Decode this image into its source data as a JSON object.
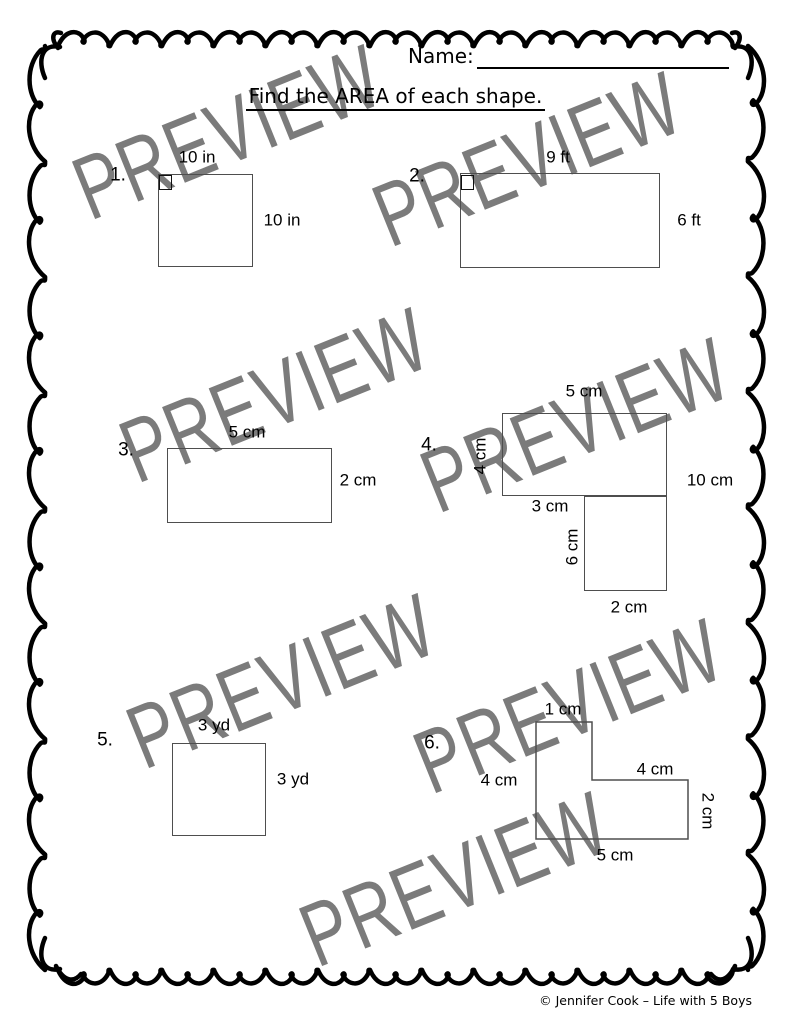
{
  "header": {
    "name_label": "Name:",
    "title": "Find the AREA of each shape."
  },
  "watermark": {
    "text": "PREVIEW",
    "color": "#7b7b7b"
  },
  "problems": [
    {
      "number": "1.",
      "shape": "square",
      "labels": {
        "top": "10 in",
        "right": "10 in"
      }
    },
    {
      "number": "2.",
      "shape": "rectangle",
      "labels": {
        "top": "9 ft",
        "right": "6 ft"
      }
    },
    {
      "number": "3.",
      "shape": "rectangle",
      "labels": {
        "top": "5 cm",
        "right": "2 cm"
      }
    },
    {
      "number": "4.",
      "shape": "composite-rectangles",
      "labels": {
        "top": "5 cm",
        "left_upper": "4 cm",
        "right": "10 cm",
        "middle": "3 cm",
        "left_lower": "6 cm",
        "bottom": "2 cm"
      }
    },
    {
      "number": "5.",
      "shape": "square",
      "labels": {
        "top": "3 yd",
        "right": "3 yd"
      }
    },
    {
      "number": "6.",
      "shape": "l-shape",
      "labels": {
        "top": "1 cm",
        "left": "4 cm",
        "step": "4 cm",
        "right": "2 cm",
        "bottom": "5 cm"
      }
    }
  ],
  "footer": {
    "copyright": "© Jennifer Cook – Life with 5 Boys"
  }
}
